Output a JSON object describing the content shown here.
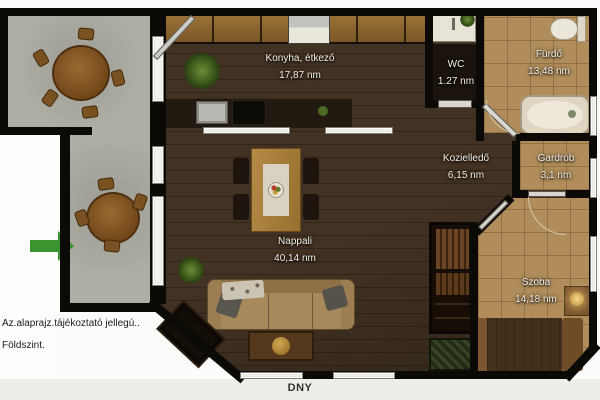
{
  "plan": {
    "rooms": [
      {
        "name": "Konyha,  étkező",
        "area": "17,87 nm"
      },
      {
        "name": "WC",
        "area": "1.27 nm"
      },
      {
        "name": "Fürdő",
        "area": "13,48 nm"
      },
      {
        "name": "Kozielledő",
        "area": "6,15 nm"
      },
      {
        "name": "Gardrób",
        "area": "3,1 nm"
      },
      {
        "name": "Nappali",
        "area": "40,14 nm"
      },
      {
        "name": "Szoba",
        "area": "14,18 nm"
      }
    ],
    "notes": {
      "line1": "Az.alaprajz.tájékoztató jellegú..",
      "line2": "Földszint."
    },
    "compass": "DNY",
    "colors": {
      "wall": "#0c0a07",
      "wood_floor": "#3e2e1f",
      "tile_floor": "#b08d5a",
      "terrace_floor": "#aeaea5",
      "entry_arrow": "#3c9430",
      "label_text": "#f2efe6"
    }
  }
}
